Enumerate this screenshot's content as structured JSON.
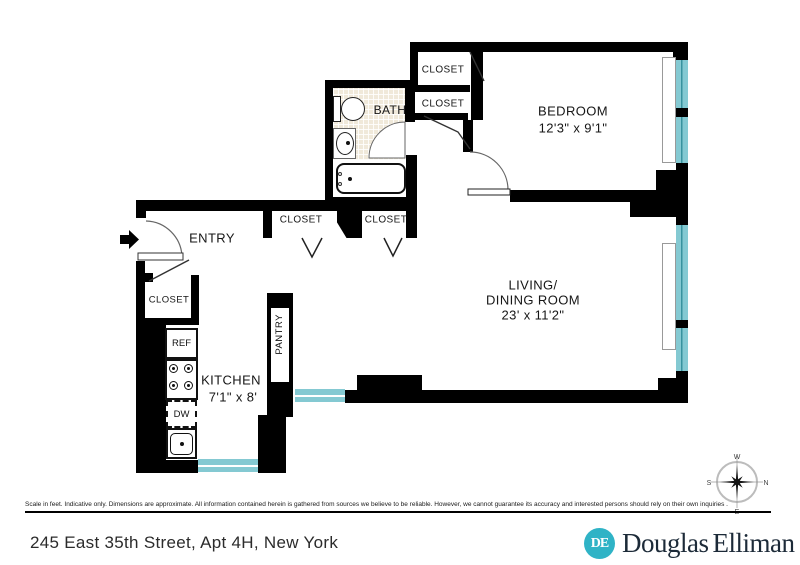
{
  "floorplan": {
    "labels": {
      "bedroom": "BEDROOM",
      "bedroom_dims": "12'3\" x 9'1\"",
      "living_line1": "LIVING/",
      "living_line2": "DINING ROOM",
      "living_dims": "23' x 11'2\"",
      "kitchen": "KITCHEN",
      "kitchen_dims": "7'1\" x 8'",
      "bath": "BATH",
      "entry": "ENTRY",
      "pantry": "PANTRY",
      "closet": "CLOSET",
      "ref": "REF",
      "dw": "DW"
    },
    "compass": {
      "n": "N",
      "s": "S",
      "e": "E",
      "w": "W"
    },
    "colors": {
      "wall": "#000000",
      "window_teal": "#84c9d2",
      "tile": "#f0e9da",
      "logo_teal": "#2fb3c6"
    }
  },
  "footer": {
    "disclaimer": "Scale in feet. Indicative only. Dimensions are approximate. All information contained herein is gathered from sources we believe to be reliable. However, we cannot guarantee its accuracy and interested persons should rely on their own inquiries .",
    "address": "245 East 35th Street, Apt 4H, New York",
    "logo": {
      "monogram": "DE",
      "name_part1": "Douglas",
      "name_part2": "Elliman"
    }
  }
}
